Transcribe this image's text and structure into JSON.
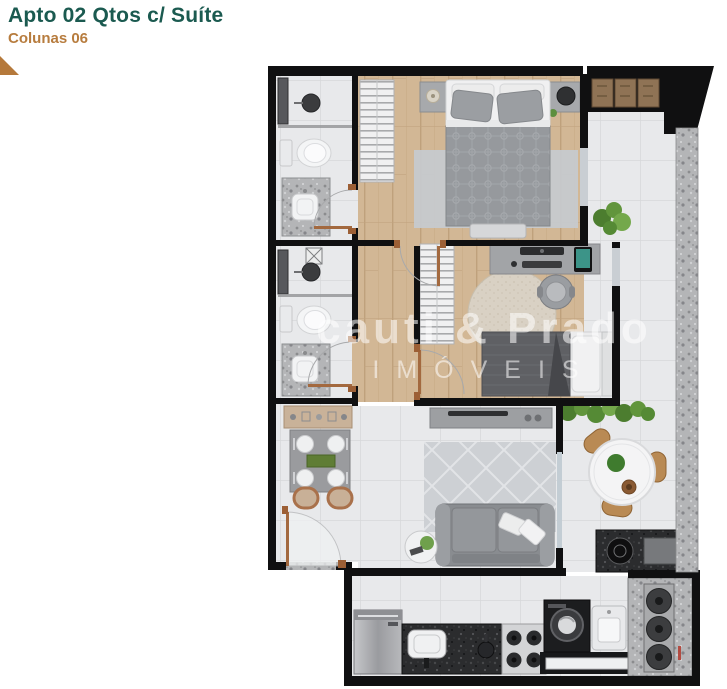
{
  "header": {
    "title": "Apto 02 Qtos c/ Suíte",
    "subtitle": "Colunas 06"
  },
  "watermark": {
    "line1": "cauti & Prado",
    "line2": "IMÓVEIS"
  },
  "colors": {
    "title_text": "#1b5a50",
    "subtitle_text": "#b77c3e",
    "corner_triangle": "#b5793b",
    "walls": "#101011",
    "wood_floor": "#d2b795",
    "tile_floor": "#e8e9eb",
    "granite_ledge": "#b4b5b7",
    "plant_green": "#5d8f3e",
    "watermark_text": "rgba(255,255,255,0.55)"
  }
}
